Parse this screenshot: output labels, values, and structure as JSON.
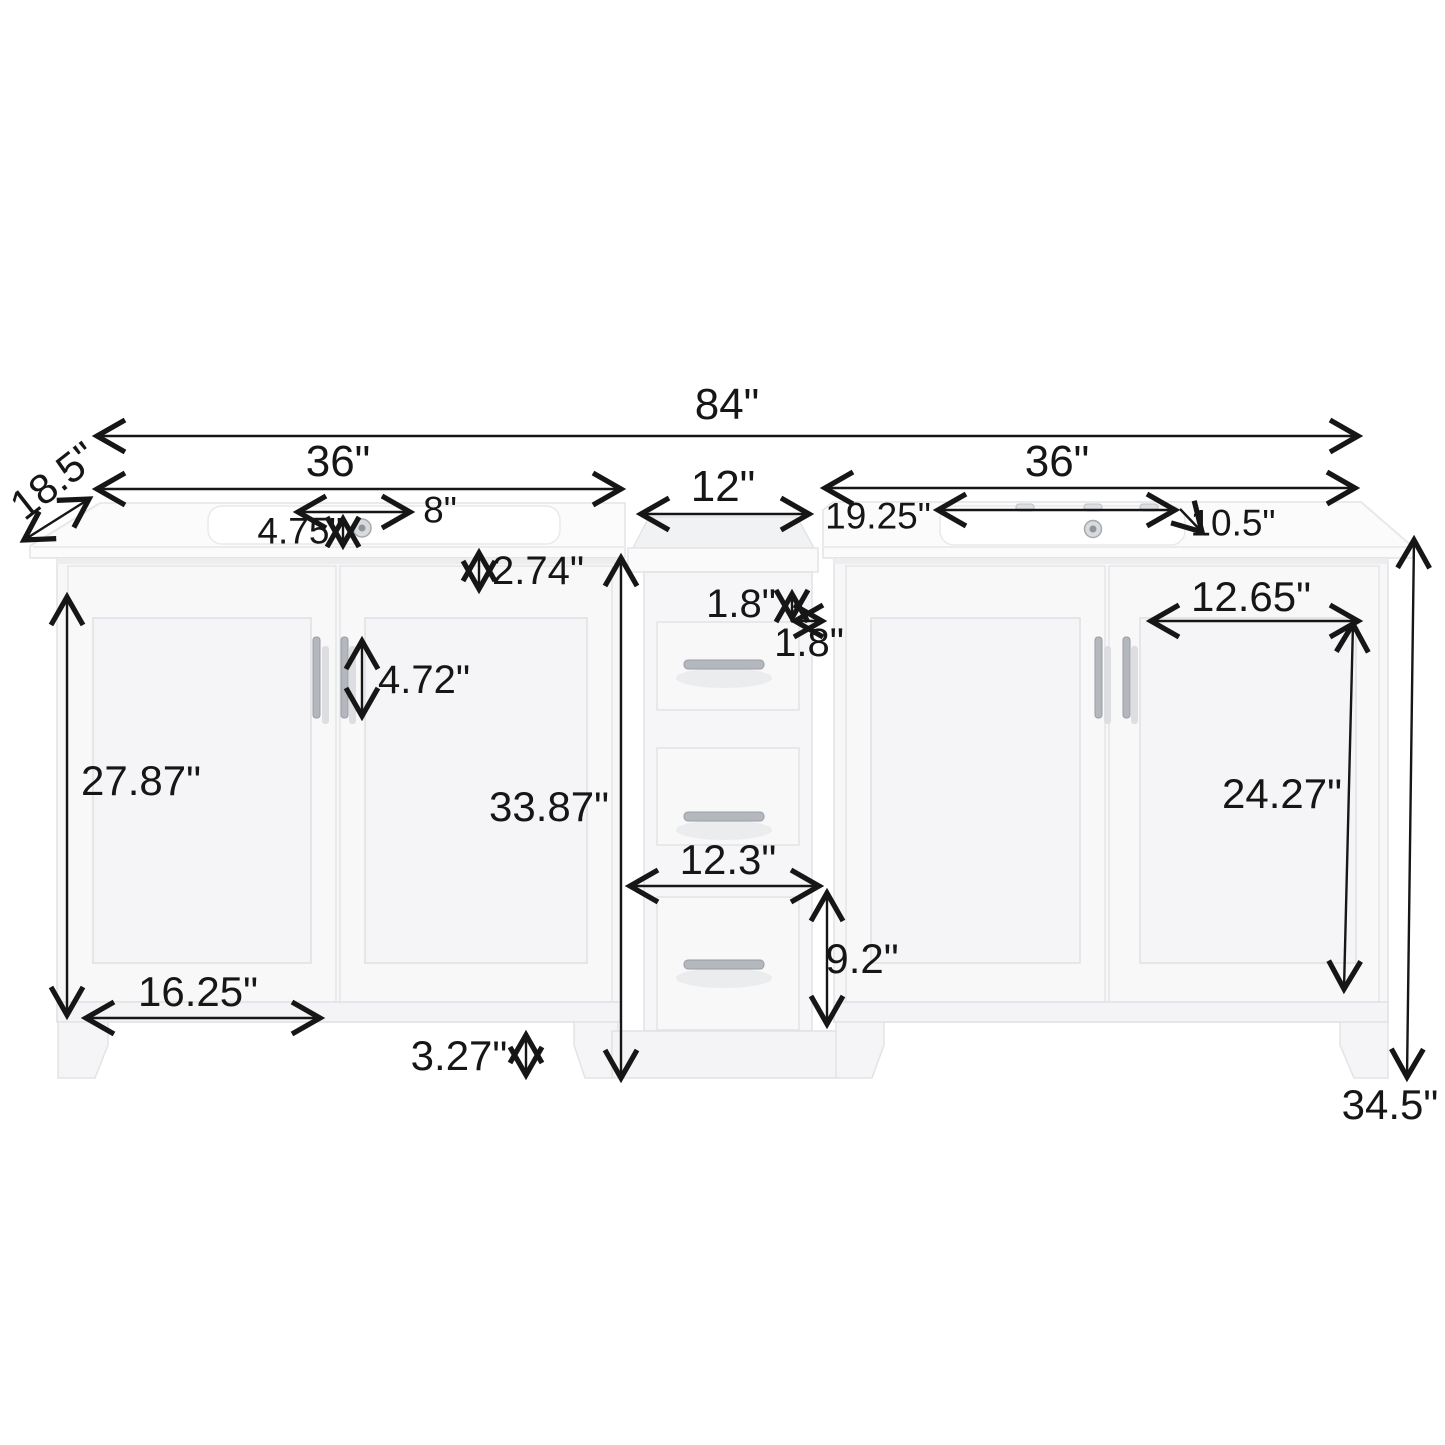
{
  "figure": {
    "type": "product-dimension-diagram",
    "subject": "84 inch double sink bathroom vanity with center drawer tower",
    "units": "inches",
    "colors": {
      "background": "#ffffff",
      "dimension_line": "#161616",
      "cabinet_fill": "#f7f7f8",
      "cabinet_edge": "#e0e2e5",
      "counter_fill": "#fcfcfd",
      "handle_metal": "#b4b8be"
    }
  },
  "dimensions": {
    "overall_width": "84\"",
    "left_vanity_width": "36\"",
    "right_vanity_width": "36\"",
    "depth": "18.5\"",
    "middle_cabinet_width": "12\"",
    "left_faucet_offset": "4.75\"",
    "faucet_hole_spacing": "8\"",
    "countertop_thickness": "2.74\"",
    "right_sink_width": "19.25\"",
    "right_sink_depth": "10.5\"",
    "drawer_top_gap": "1.8\"",
    "drawer_side_gap": "1.8\"",
    "handle_length": "4.72\"",
    "left_door_height": "27.87\"",
    "middle_cabinet_height": "33.87\"",
    "right_door_panel_width": "12.65\"",
    "right_door_panel_height": "24.27\"",
    "middle_cabinet_outer_width": "12.3\"",
    "bottom_drawer_height": "9.2\"",
    "left_door_panel_width": "16.25\"",
    "leg_height": "3.27\"",
    "overall_height": "34.5\""
  }
}
